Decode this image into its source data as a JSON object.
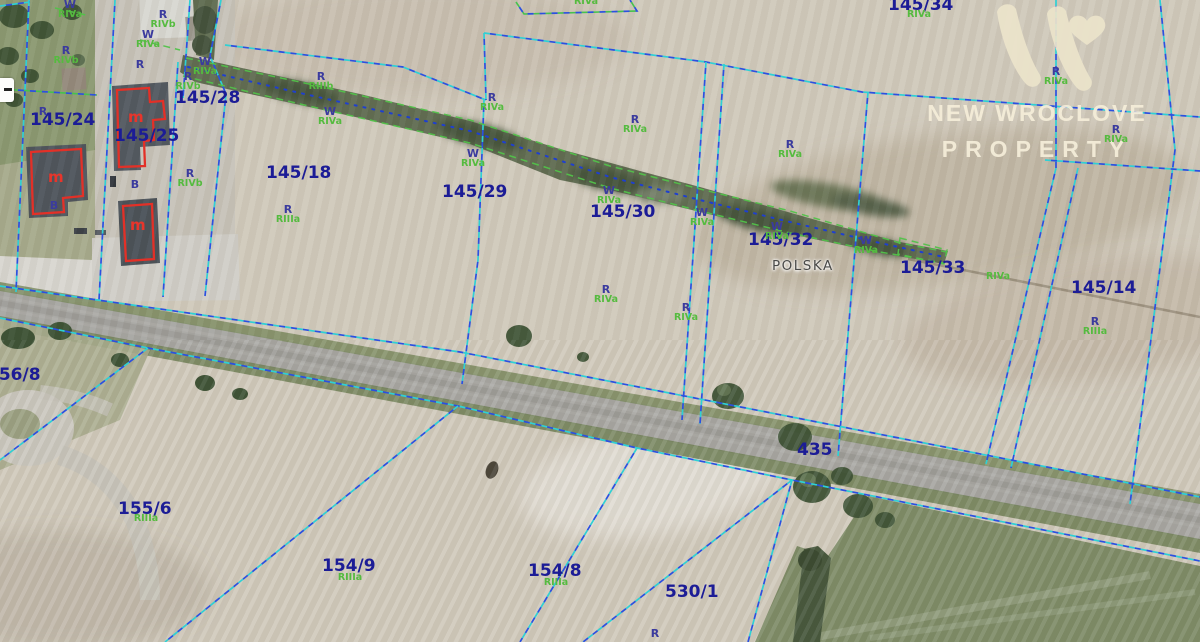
{
  "map": {
    "place_label": "POLSKA",
    "road_number": "435",
    "parcels": [
      {
        "id": "145/24",
        "x": 30,
        "y": 110
      },
      {
        "id": "145/25",
        "x": 114,
        "y": 126
      },
      {
        "id": "145/28",
        "x": 175,
        "y": 88
      },
      {
        "id": "145/18",
        "x": 266,
        "y": 163
      },
      {
        "id": "145/29",
        "x": 442,
        "y": 182
      },
      {
        "id": "145/30",
        "x": 590,
        "y": 202
      },
      {
        "id": "145/32",
        "x": 748,
        "y": 230
      },
      {
        "id": "145/33",
        "x": 900,
        "y": 258
      },
      {
        "id": "145/34",
        "x": 888,
        "y": -5
      },
      {
        "id": "145/14",
        "x": 1071,
        "y": 278
      },
      {
        "id": "156/8",
        "x": -13,
        "y": 365
      },
      {
        "id": "155/6",
        "x": 118,
        "y": 499
      },
      {
        "id": "154/9",
        "x": 322,
        "y": 556
      },
      {
        "id": "154/8",
        "x": 528,
        "y": 561
      },
      {
        "id": "530/1",
        "x": 665,
        "y": 582
      }
    ],
    "soil_marks": [
      {
        "letter": "W",
        "code": "RIVa",
        "x": 70,
        "y": 0
      },
      {
        "letter": "R",
        "code": "RIVb",
        "x": 163,
        "y": 10
      },
      {
        "letter": "W",
        "code": "RIVa",
        "x": 148,
        "y": 30
      },
      {
        "letter": "R",
        "code": "RIVb",
        "x": 66,
        "y": 46
      },
      {
        "letter": "W",
        "code": "RIVa",
        "x": 205,
        "y": 57
      },
      {
        "letter": "R",
        "code": "RIVb",
        "x": 188,
        "y": 72
      },
      {
        "letter": "R",
        "code": "",
        "x": 140,
        "y": 60
      },
      {
        "letter": "R",
        "code": "",
        "x": 43,
        "y": 107
      },
      {
        "letter": "R",
        "code": "RIVb",
        "x": 190,
        "y": 169
      },
      {
        "letter": "B",
        "code": "",
        "x": 135,
        "y": 180
      },
      {
        "letter": "B",
        "code": "",
        "x": 54,
        "y": 201
      },
      {
        "letter": "R",
        "code": "RIIIb",
        "x": 321,
        "y": 72
      },
      {
        "letter": "W",
        "code": "RIVa",
        "x": 330,
        "y": 107
      },
      {
        "letter": "R",
        "code": "RIVa",
        "x": 492,
        "y": 93
      },
      {
        "letter": "R",
        "code": "RIIIa",
        "x": 288,
        "y": 205
      },
      {
        "letter": "W",
        "code": "RIVa",
        "x": 473,
        "y": 149
      },
      {
        "letter": "R",
        "code": "RIVa",
        "x": 635,
        "y": 115
      },
      {
        "letter": "R",
        "code": "RIVa",
        "x": 790,
        "y": 140
      },
      {
        "letter": "W",
        "code": "RIVa",
        "x": 609,
        "y": 186
      },
      {
        "letter": "W",
        "code": "RIVa",
        "x": 702,
        "y": 208
      },
      {
        "letter": "W",
        "code": "RIVa",
        "x": 777,
        "y": 222
      },
      {
        "letter": "W",
        "code": "RIVa",
        "x": 866,
        "y": 236
      },
      {
        "letter": "R",
        "code": "RIVa",
        "x": 606,
        "y": 285
      },
      {
        "letter": "R",
        "code": "RIVa",
        "x": 686,
        "y": 303
      },
      {
        "letter": "",
        "code": "RIVa",
        "x": 919,
        "y": 10
      },
      {
        "letter": "R",
        "code": "RIVa",
        "x": 1056,
        "y": 67
      },
      {
        "letter": "R",
        "code": "RIVa",
        "x": 1116,
        "y": 125
      },
      {
        "letter": "R",
        "code": "RIIIa",
        "x": 1095,
        "y": 317
      },
      {
        "letter": "",
        "code": "RIVa",
        "x": 998,
        "y": 272
      },
      {
        "letter": "",
        "code": "RIIIa",
        "x": 146,
        "y": 514
      },
      {
        "letter": "",
        "code": "RIIIa",
        "x": 350,
        "y": 573
      },
      {
        "letter": "",
        "code": "RIIIa",
        "x": 556,
        "y": 578
      },
      {
        "letter": "R",
        "code": "",
        "x": 655,
        "y": 629
      },
      {
        "letter": "",
        "code": "RIVa",
        "x": 586,
        "y": -3
      }
    ],
    "building_marks": [
      {
        "label": "m",
        "x": 48,
        "y": 168
      },
      {
        "label": "m",
        "x": 128,
        "y": 108
      },
      {
        "label": "m",
        "x": 130,
        "y": 216
      }
    ],
    "colors": {
      "parcel_label": "#1c1c96",
      "soil_letter": "#3b3b9e",
      "soil_code": "#55bb3f",
      "cadastral_cyan": "#2fd0d4",
      "cadastral_blue": "#2b50e0",
      "use_green": "#52c24a",
      "building_outline": "#e33027",
      "place_label_color": "#4a4a48"
    }
  },
  "watermark": {
    "brand_line1": "NEW WROCLOVE",
    "brand_line2": "PROPERTY",
    "logo": "w-heart-logo",
    "logo_color": "#ece4cb"
  }
}
